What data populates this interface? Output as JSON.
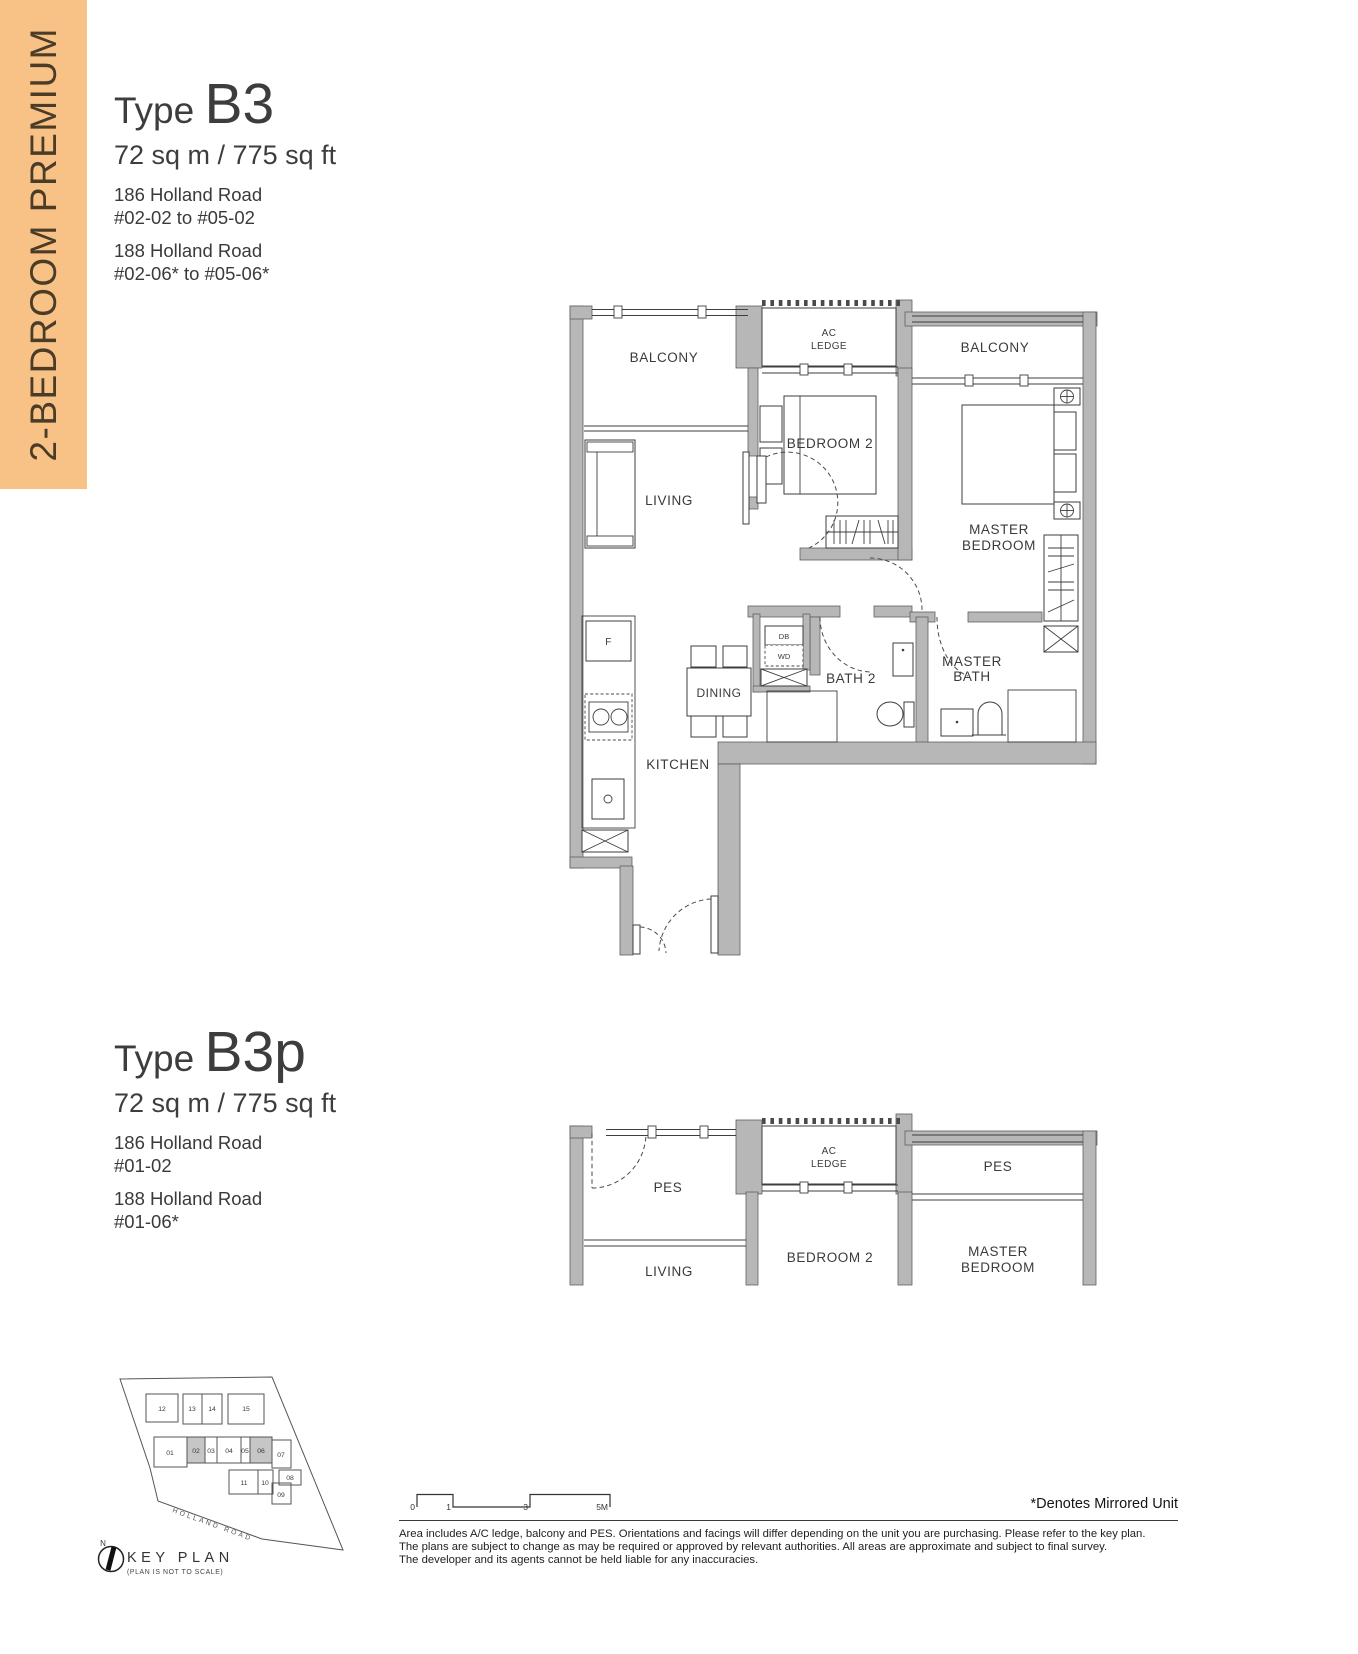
{
  "banner": {
    "label": "2-BEDROOM PREMIUM",
    "bg_color": "#F8C286",
    "text_color": "#4B3C28"
  },
  "b3": {
    "type_label": "Type",
    "type_code": "B3",
    "area": "72 sq m / 775 sq ft",
    "addr1": "186 Holland Road",
    "addr1_units": "#02-02 to #05-02",
    "addr2": "188 Holland Road",
    "addr2_units": "#02-06* to #05-06*"
  },
  "b3p": {
    "type_label": "Type",
    "type_code": "B3p",
    "area": "72 sq m / 775 sq ft",
    "addr1": "186 Holland Road",
    "addr1_units": "#01-02",
    "addr2": "188 Holland Road",
    "addr2_units": "#01-06*"
  },
  "plan_b3": {
    "labels": {
      "balcony_l": "BALCONY",
      "balcony_r": "BALCONY",
      "ac1": "AC",
      "ac2": "LEDGE",
      "bedroom2": "BEDROOM 2",
      "living": "LIVING",
      "master1": "MASTER",
      "master2": "BEDROOM",
      "dining": "DINING",
      "bath2": "BATH 2",
      "mbath1": "MASTER",
      "mbath2": "BATH",
      "kitchen": "KITCHEN",
      "fridge": "F",
      "db": "DB",
      "wd": "WD"
    }
  },
  "plan_b3p": {
    "labels": {
      "pes_l": "PES",
      "pes_r": "PES",
      "ac1": "AC",
      "ac2": "LEDGE",
      "living": "LIVING",
      "bedroom2": "BEDROOM 2",
      "master1": "MASTER",
      "master2": "BEDROOM"
    }
  },
  "keyplan": {
    "title": "KEY PLAN",
    "subtitle": "(PLAN IS NOT TO SCALE)",
    "north": "N",
    "road": "HOLLAND ROAD",
    "units_top": [
      "12",
      "13",
      "14",
      "15"
    ],
    "units_mid": [
      "01",
      "02",
      "03",
      "04",
      "05",
      "06",
      "07"
    ],
    "units_low": [
      "11",
      "10",
      "09",
      "08"
    ],
    "highlighted_stacks": [
      "02",
      "06"
    ],
    "highlight_color": "#C6C6C6"
  },
  "scalebar": {
    "t0": "0",
    "t1": "1",
    "t2": "3",
    "t3": "5M"
  },
  "footer": {
    "mirror_note": "*Denotes Mirrored Unit",
    "disclaimer1": "Area includes A/C ledge, balcony and PES. Orientations and facings will differ depending on the unit you are purchasing. Please refer to the key plan.",
    "disclaimer2": "The plans are subject to change as may be required or approved by relevant authorities. All areas are approximate and subject to final survey.",
    "disclaimer3": "The developer and its agents cannot be held liable for any inaccuracies."
  },
  "colors": {
    "wall_gray": "#B7B7B7",
    "line": "#3E3E3E"
  }
}
